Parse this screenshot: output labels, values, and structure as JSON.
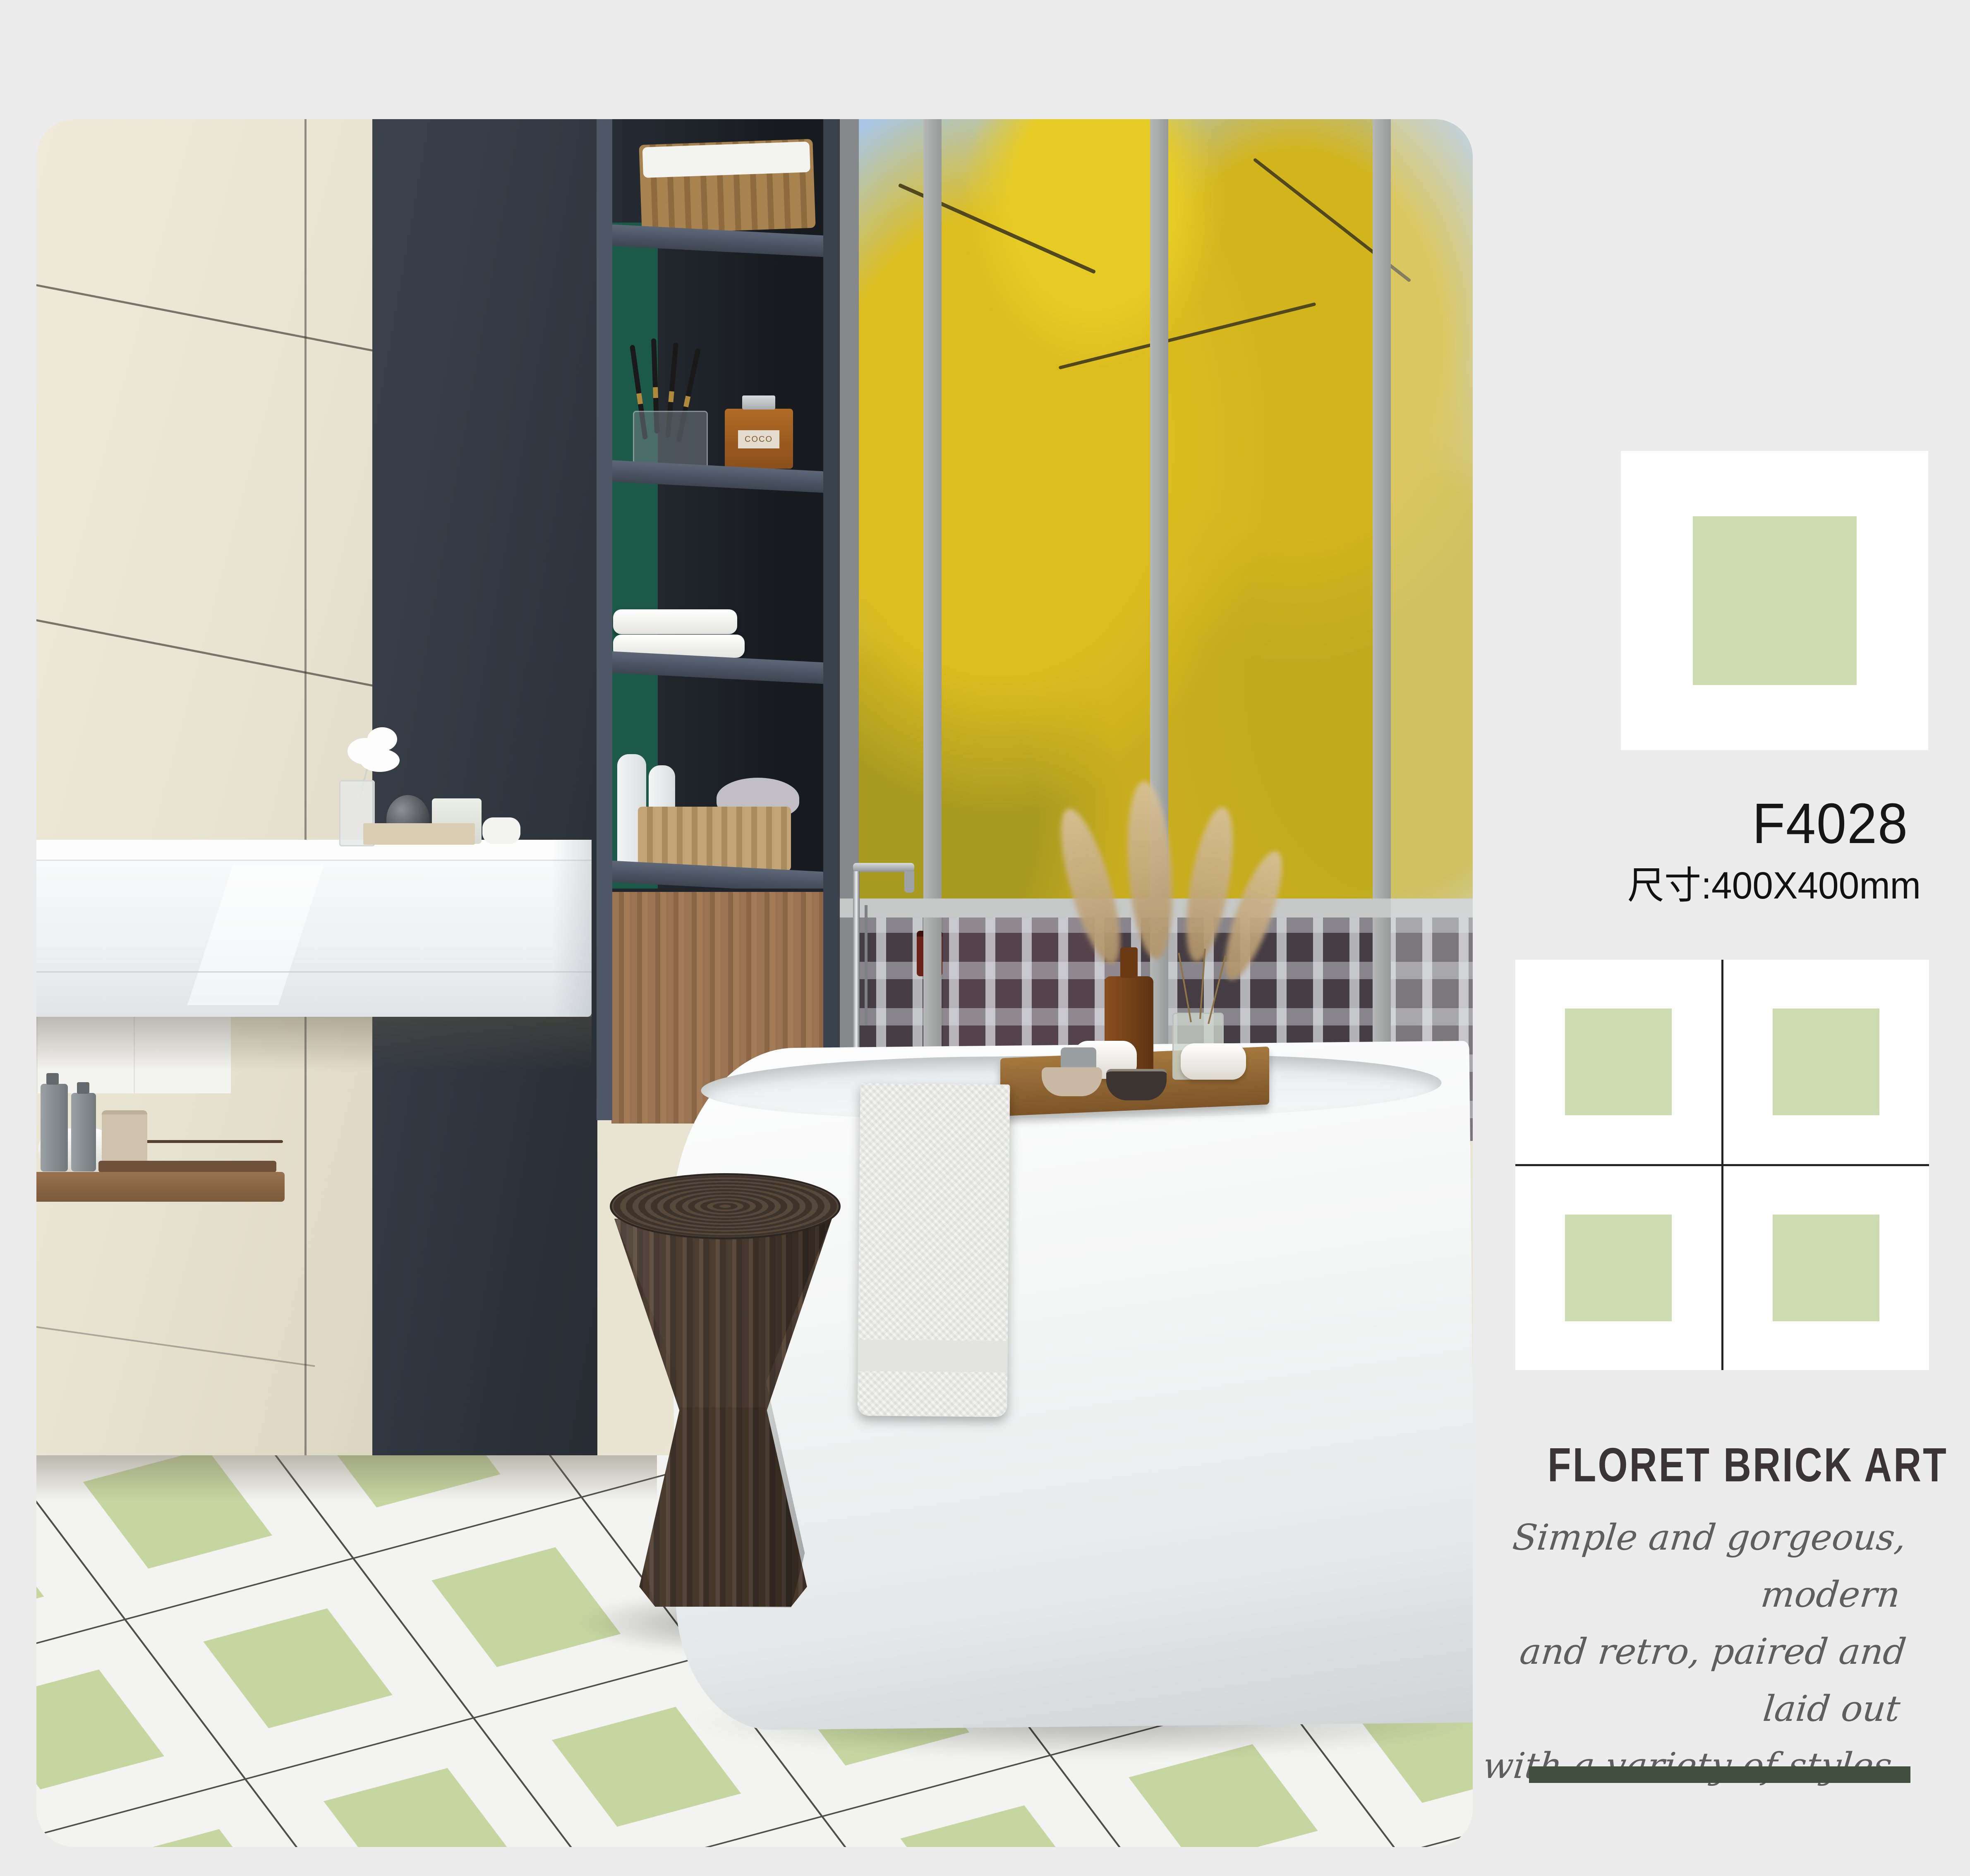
{
  "page": {
    "background": "#ececed"
  },
  "product": {
    "code": "F4028",
    "size_label": "尺寸:400X400mm",
    "series_title": "FLORET BRICK ART",
    "tagline": [
      "Simple and gorgeous, modern",
      "and retro, paired and laid out",
      "with a variety of styles,"
    ]
  },
  "scene": {
    "perfume_label": "COCO"
  },
  "palette": {
    "tile_green": "#cddbb0",
    "floor_green": "#c6d6a1",
    "grout_dark": "#242424",
    "accent_bar_green": "#424e3d",
    "heading_color": "#3b3436",
    "script_gray": "#5e5e5e",
    "code_black": "#161616",
    "cream_wall": "#e9e4d2",
    "dark_wall": "#31373f",
    "foliage_yellow": "#d9b91e",
    "sky_blue": "#a9c6e6",
    "wood_brown": "#997452"
  }
}
